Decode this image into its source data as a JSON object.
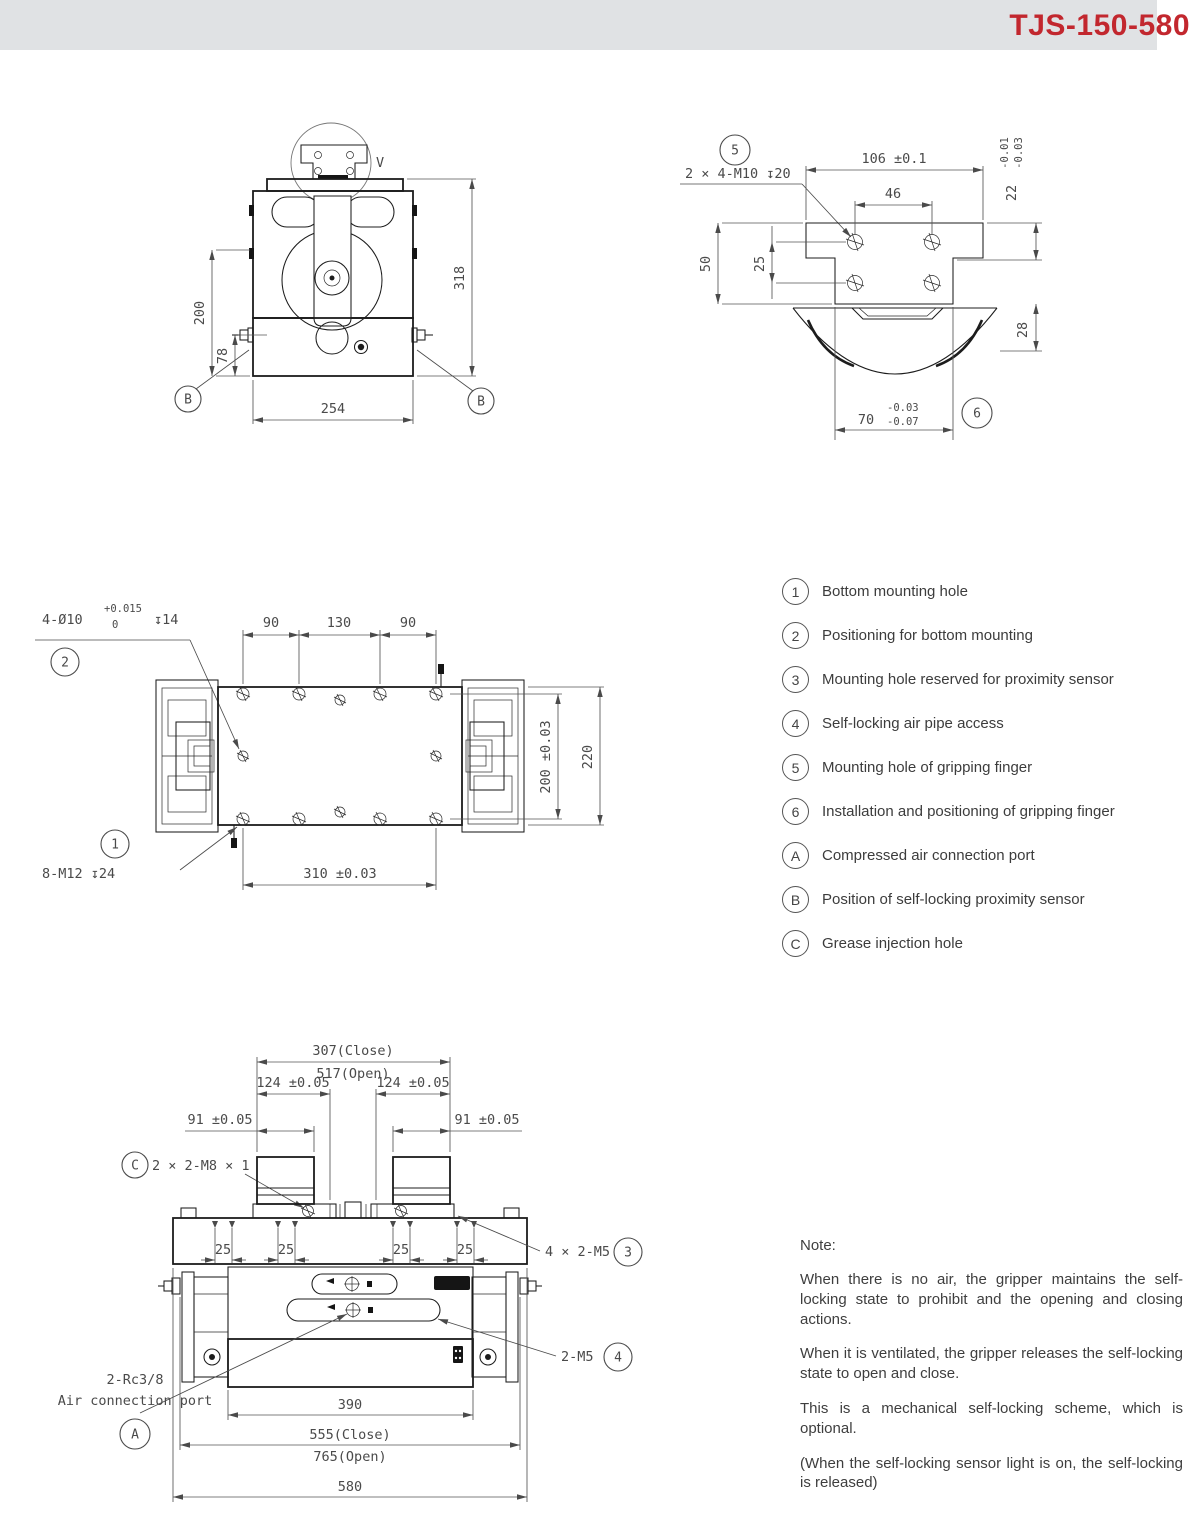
{
  "header": {
    "title": "TJS-150-580"
  },
  "front_view": {
    "detail_marker": "V",
    "dim_upper": "200",
    "dim_sensor": "78",
    "dim_total": "318",
    "dim_base": "254",
    "balloon_sensor": "B"
  },
  "detail_view": {
    "balloon_mount": "5",
    "thread_callout": "2 × 4-M10 ↧20",
    "dim_top_width": "106 ±0.1",
    "dim_hole_pitch": "46",
    "dim_height": "50",
    "dim_row_pitch": "25",
    "dim_step": "22",
    "step_tol_upper": "-0.01",
    "step_tol_lower": "-0.03",
    "dim_boss_height": "28",
    "dim_boss_width": "70",
    "boss_tol_upper": "-0.03",
    "boss_tol_lower": "-0.07",
    "balloon_position": "6"
  },
  "plan_view": {
    "callout_holes": "4-Ø10",
    "tol_upper": "+0.015",
    "tol_lower": "0",
    "depth": "↧14",
    "balloon_positioning": "2",
    "dim_90a": "90",
    "dim_130": "130",
    "dim_90b": "90",
    "dim_rows": "200 ±0.03",
    "dim_width": "220",
    "dim_span": "310 ±0.03",
    "balloon_mounting": "1",
    "callout_mounting": "8-M12 ↧24"
  },
  "side_view": {
    "dim_close": "307(Close)",
    "dim_open": "517(Open)",
    "dim_124": "124 ±0.05",
    "dim_91": "91 ±0.05",
    "balloon_grease": "C",
    "callout_grease": "2 × 2-M8 × 1",
    "dim_25": "25",
    "callout_sensor": "4 × 2-M5",
    "balloon_sensor": "3",
    "callout_airpipe": "2-M5",
    "balloon_airpipe": "4",
    "callout_air_line1": "2-Rc3/8",
    "callout_air_line2": "Air connection port",
    "balloon_air": "A",
    "dim_390": "390",
    "dim_555": "555(Close)",
    "dim_765": "765(Open)",
    "dim_580": "580"
  },
  "legend": {
    "items": [
      {
        "symbol": "1",
        "label": "Bottom mounting hole"
      },
      {
        "symbol": "2",
        "label": "Positioning for bottom mounting"
      },
      {
        "symbol": "3",
        "label": "Mounting hole reserved for proximity sensor"
      },
      {
        "symbol": "4",
        "label": "Self-locking air pipe access"
      },
      {
        "symbol": "5",
        "label": "Mounting hole of gripping finger"
      },
      {
        "symbol": "6",
        "label": "Installation and positioning of gripping finger"
      },
      {
        "symbol": "A",
        "label": "Compressed air connection port"
      },
      {
        "symbol": "B",
        "label": "Position of self-locking proximity sensor"
      },
      {
        "symbol": "C",
        "label": "Grease injection hole"
      }
    ]
  },
  "note": {
    "title": "Note:",
    "paragraphs": [
      "When there is no air, the gripper maintains the self-locking state to prohibit and the opening and closing actions.",
      "When it is ventilated, the gripper releases the self-locking state to open and close.",
      "This is a mechanical self-locking scheme, which is optional.",
      "(When the self-locking sensor light is on, the self-locking is released)"
    ]
  }
}
